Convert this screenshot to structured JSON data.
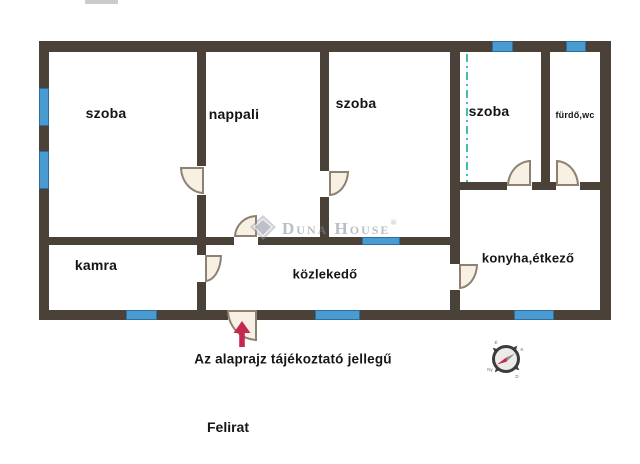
{
  "rooms": [
    {
      "id": "szoba-1",
      "label": "szoba"
    },
    {
      "id": "nappali",
      "label": "nappali"
    },
    {
      "id": "szoba-2",
      "label": "szoba"
    },
    {
      "id": "szoba-3",
      "label": "szoba"
    },
    {
      "id": "furdo-wc",
      "label": "fürdő,wc"
    },
    {
      "id": "kamra",
      "label": "kamra"
    },
    {
      "id": "kozlekedo",
      "label": "közlekedő"
    },
    {
      "id": "konyha-etkezo",
      "label": "konyha,étkező"
    }
  ],
  "watermark": {
    "brand": "Duna House",
    "registered": "®"
  },
  "notes": {
    "disclaimer": "Az alaprajz tájékoztató jellegű",
    "caption": "Felirat"
  },
  "compass": {
    "north": "É",
    "east": "K",
    "south": "D",
    "west": "Ny"
  },
  "colors": {
    "wall": "#4a4138",
    "window_fill": "#4a9bd1",
    "window_border": "#2e6e9e",
    "door_fill": "#f8f1e3",
    "door_border": "#8d8174",
    "virtual_divider_teal": "#41c1ab",
    "entrance_arrow_red": "#c32950",
    "watermark_gray": "#828896",
    "label_text": "#141414"
  }
}
